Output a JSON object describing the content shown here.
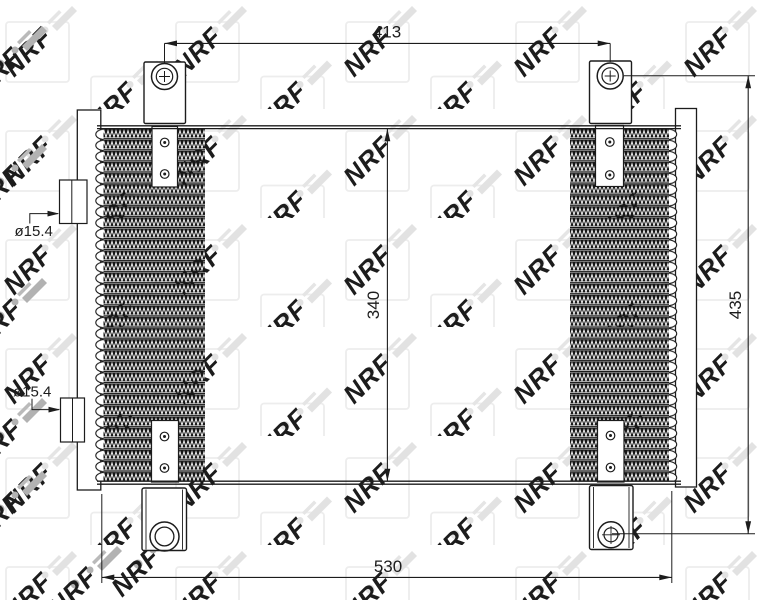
{
  "watermark": {
    "text": "NRF"
  },
  "labels": {
    "dim_top_width": "413",
    "dim_core_height": "340",
    "dim_overall_height": "435",
    "dim_bottom_width": "530",
    "upper_port_diameter": "ø15.4",
    "lower_port_diameter": "ø15.4"
  },
  "colors": {
    "line": "#1c1c1c",
    "fin_black": "#161616",
    "watermark_light": "#e2e2e2",
    "watermark_dark": "#b2b2b2",
    "background": "#ffffff"
  }
}
